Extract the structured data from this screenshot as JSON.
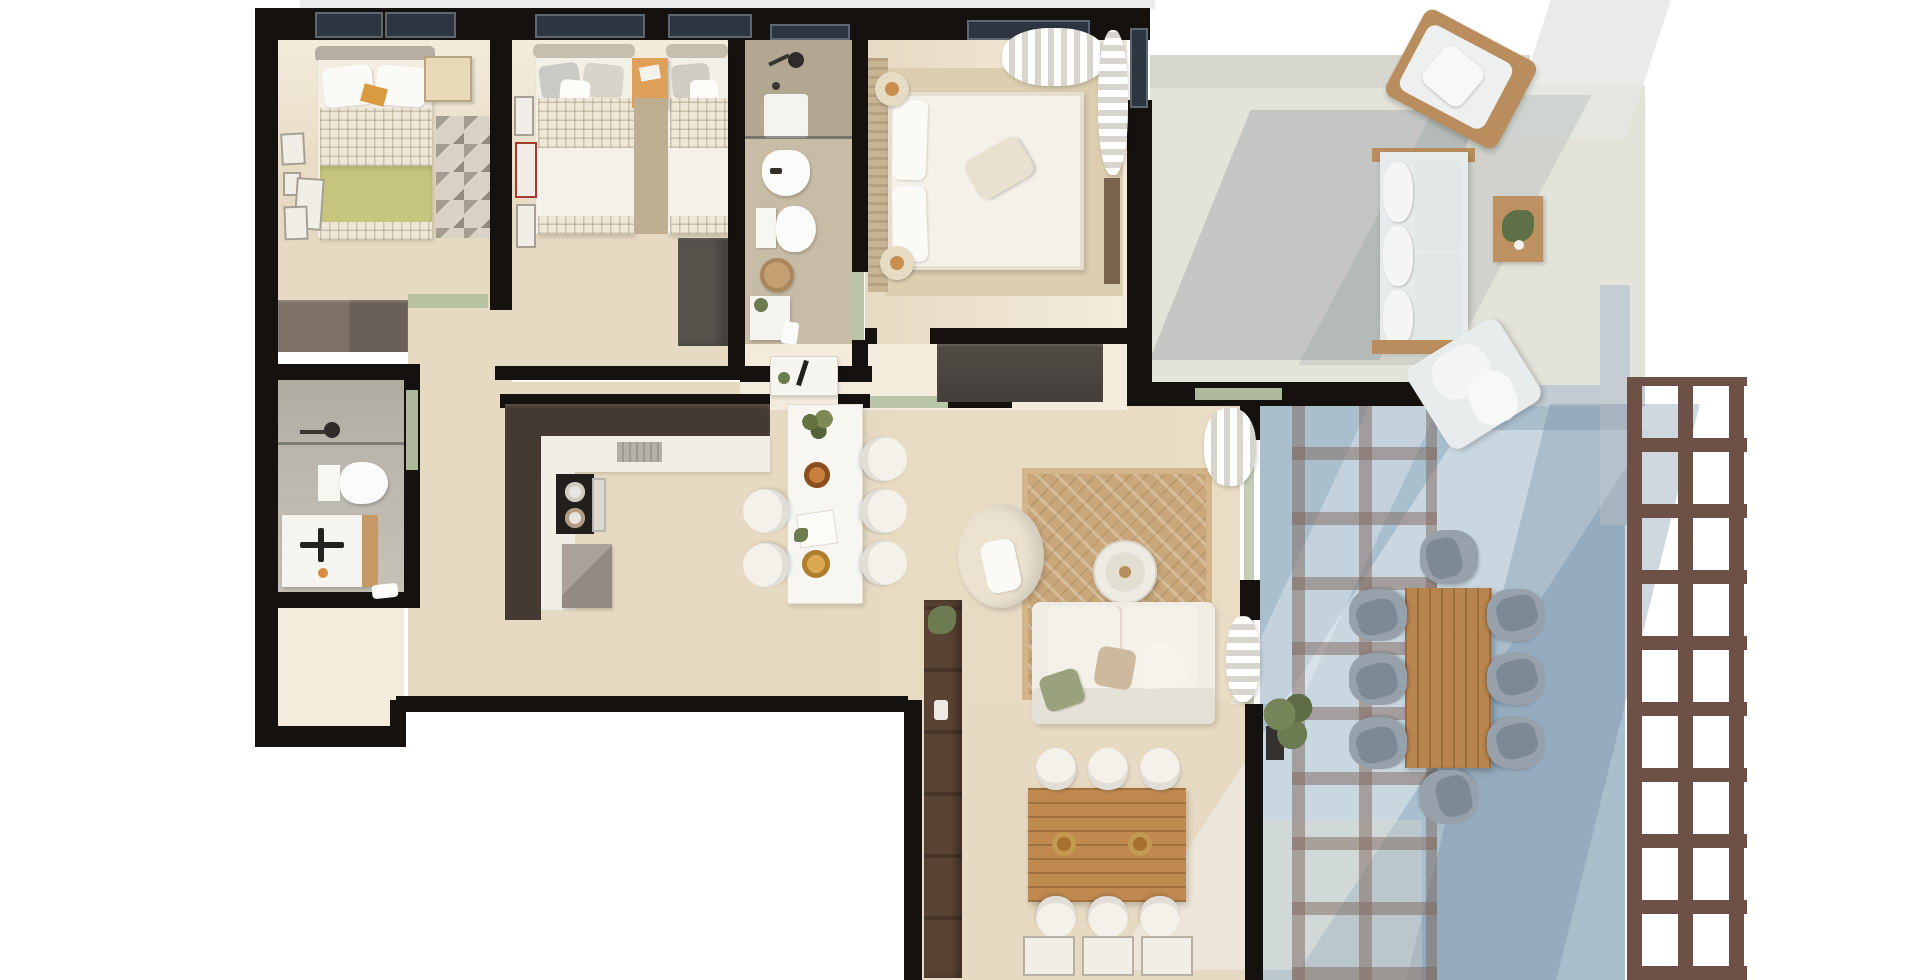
{
  "scene": {
    "type": "architectural-floor-plan",
    "view": "top-down 3d render",
    "content": "apartment floor plan with three bedrooms, two bathrooms, kitchen with island dining, living room, separate dining room and a large two-level terrace with pergola",
    "text_visible": "none"
  },
  "palette": {
    "bg": "#ffffff",
    "wall": "#14110e",
    "floor": "#e7dac2",
    "floor_light": "#f3ecdc",
    "floor_gray": "#bcb8af",
    "bath_floor": "#c7bca6",
    "terrace_floor": "#e4e3da",
    "terrace_blue": "#a9bfce",
    "pergola": "#6d5146",
    "pergola_shadow": "rgba(128,103,92,0.5)",
    "glass": "#2c3540",
    "door_green": "#b6c2a2",
    "counter_dark": "#453a32",
    "white_furniture": "#f3f1ea",
    "wood": "#bf8950",
    "wood_dark": "#5a4332",
    "jute": "#c9a77b",
    "olive": "#c6c57e",
    "gray_chair": "#97a1ab",
    "gold": "#c98f4f",
    "green_plant": "#6d7c50"
  },
  "rooms": [
    {
      "id": "bedroom-1",
      "furniture": [
        "single-bed-olive-blanket",
        "bedside-desk",
        "patterned-rug",
        "wardrobe",
        "wall-frames",
        "window"
      ]
    },
    {
      "id": "bedroom-2",
      "furniture": [
        "twin-bed-left",
        "twin-bed-right",
        "orange-nightstand",
        "runner-rug",
        "dark-wardrobe",
        "wall-frames",
        "windows"
      ]
    },
    {
      "id": "bathroom-top",
      "furniture": [
        "shower",
        "bidet",
        "toilet",
        "wicker-stool",
        "vanity-sink",
        "window"
      ]
    },
    {
      "id": "master-bedroom",
      "furniture": [
        "double-bed",
        "slat-headboard",
        "round-nightstand-top",
        "round-nightstand-bottom",
        "area-rug",
        "window-curtain",
        "side-cabinet"
      ]
    },
    {
      "id": "bathroom-left",
      "furniture": [
        "shower",
        "toilet",
        "vanity-sink",
        "towel"
      ]
    },
    {
      "id": "entry-hall",
      "furniture": [
        "white-console",
        "dark-wardrobe-cabinet",
        "green-entry-door"
      ]
    },
    {
      "id": "kitchen",
      "furniture": [
        "l-shaped-dark-counter",
        "white-worktop",
        "cooktop-two-pots",
        "sink",
        "extractor-vent",
        "gray-appliance"
      ]
    },
    {
      "id": "island-dining",
      "furniture": [
        "white-island-table",
        "five-white-chairs",
        "plant",
        "plates",
        "papers"
      ]
    },
    {
      "id": "living-room",
      "furniture": [
        "cream-armchair",
        "round-coffee-table",
        "jute-rug",
        "white-sofa-with-pillows",
        "billowing-curtains",
        "glass-sliding-doors"
      ]
    },
    {
      "id": "dining-room-bottom",
      "furniture": [
        "wooden-dining-table",
        "six-white-chairs",
        "tall-brown-cabinet",
        "plant",
        "three-wall-frames"
      ]
    },
    {
      "id": "terrace-upper",
      "furniture": [
        "outdoor-sofa",
        "corner-armchair",
        "diagonal-lounge-chair",
        "plant-side-table",
        "cast-shadows"
      ]
    },
    {
      "id": "terrace-lower",
      "furniture": [
        "outdoor-wood-dining-table",
        "eight-gray-chairs",
        "planter-plant",
        "pergola-lattice",
        "pergola-shadow-grid",
        "blue-tile-floor"
      ]
    }
  ],
  "counts": {
    "windows_top_wall": 6,
    "green-door-openings": 5,
    "island_chairs": 5,
    "dining_room_chairs": 6,
    "terrace_dining_chairs": 8
  },
  "chart_data": null
}
